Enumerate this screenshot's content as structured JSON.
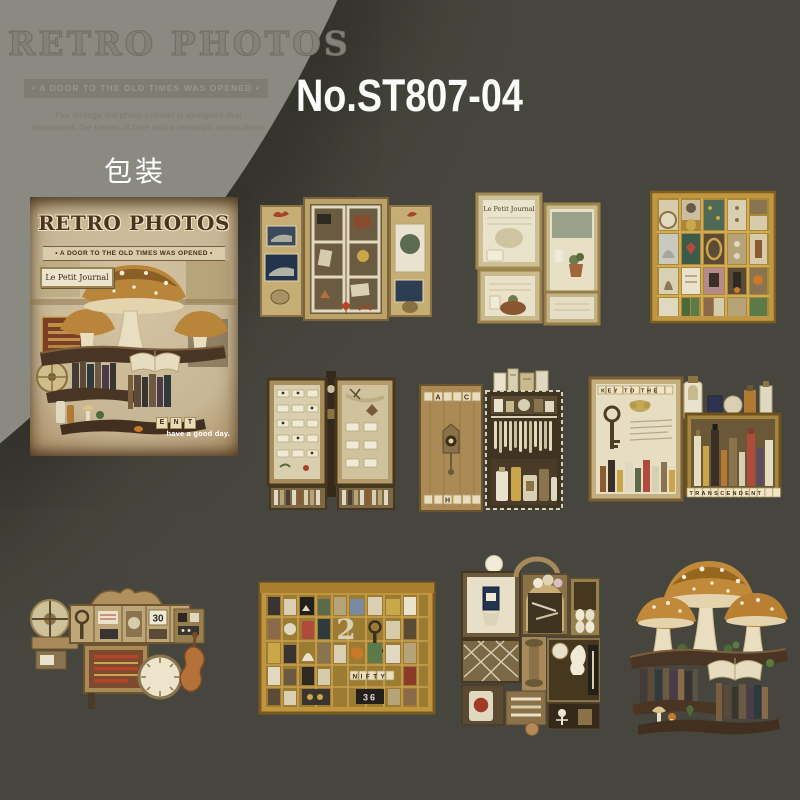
{
  "palette": {
    "background": "#47463e",
    "corner_gray": "#8b8a82",
    "gold_wood": "#c0953d",
    "cream": "#e8dfc6",
    "dark_wood": "#4a3524",
    "white": "#ffffff"
  },
  "header": {
    "watermark_title": "RETRO PHOTOS",
    "watermark_banner": "•   A DOOR TO THE OLD TIMES WAS OPENED   •",
    "tagline_line1": "The vintage old photo cabinet is designed that",
    "tagline_line2": "showcases the traces of time and a nostalgic atmosphere",
    "product_code": "No.ST807-04"
  },
  "package": {
    "section_label": "包装",
    "cover_title": "RETRO PHOTOS",
    "cover_banner": "•  A DOOR TO THE OLD TIMES WAS OPENED  •",
    "journal_sign": "Le Petit Journal",
    "tiles": [
      "E",
      "N",
      "T"
    ],
    "footer_note": "have a good day."
  },
  "stickers": [
    {
      "name": "open-window-curiosity-cabinet"
    },
    {
      "name": "newspaper-shadow-boxes",
      "sign": "Le Petit Journal"
    },
    {
      "name": "printers-tray-trinkets"
    },
    {
      "name": "specimen-display-panels"
    },
    {
      "name": "letter-tile-cuckoo-cabinet",
      "tile_a": "A",
      "tile_c": "C",
      "tile_h": "H"
    },
    {
      "name": "apothecary-bottle-shelf",
      "word_top": "KEY TO THE",
      "word_bottom": "TRANSCENDENT"
    },
    {
      "name": "clock-parts-assemblage",
      "number_card": "30"
    },
    {
      "name": "printers-tray-large",
      "big_number": "2",
      "word": "NIFTY",
      "plate_number": "36"
    },
    {
      "name": "stacked-curio-shadowbox"
    },
    {
      "name": "mushroom-bookshelf"
    }
  ]
}
